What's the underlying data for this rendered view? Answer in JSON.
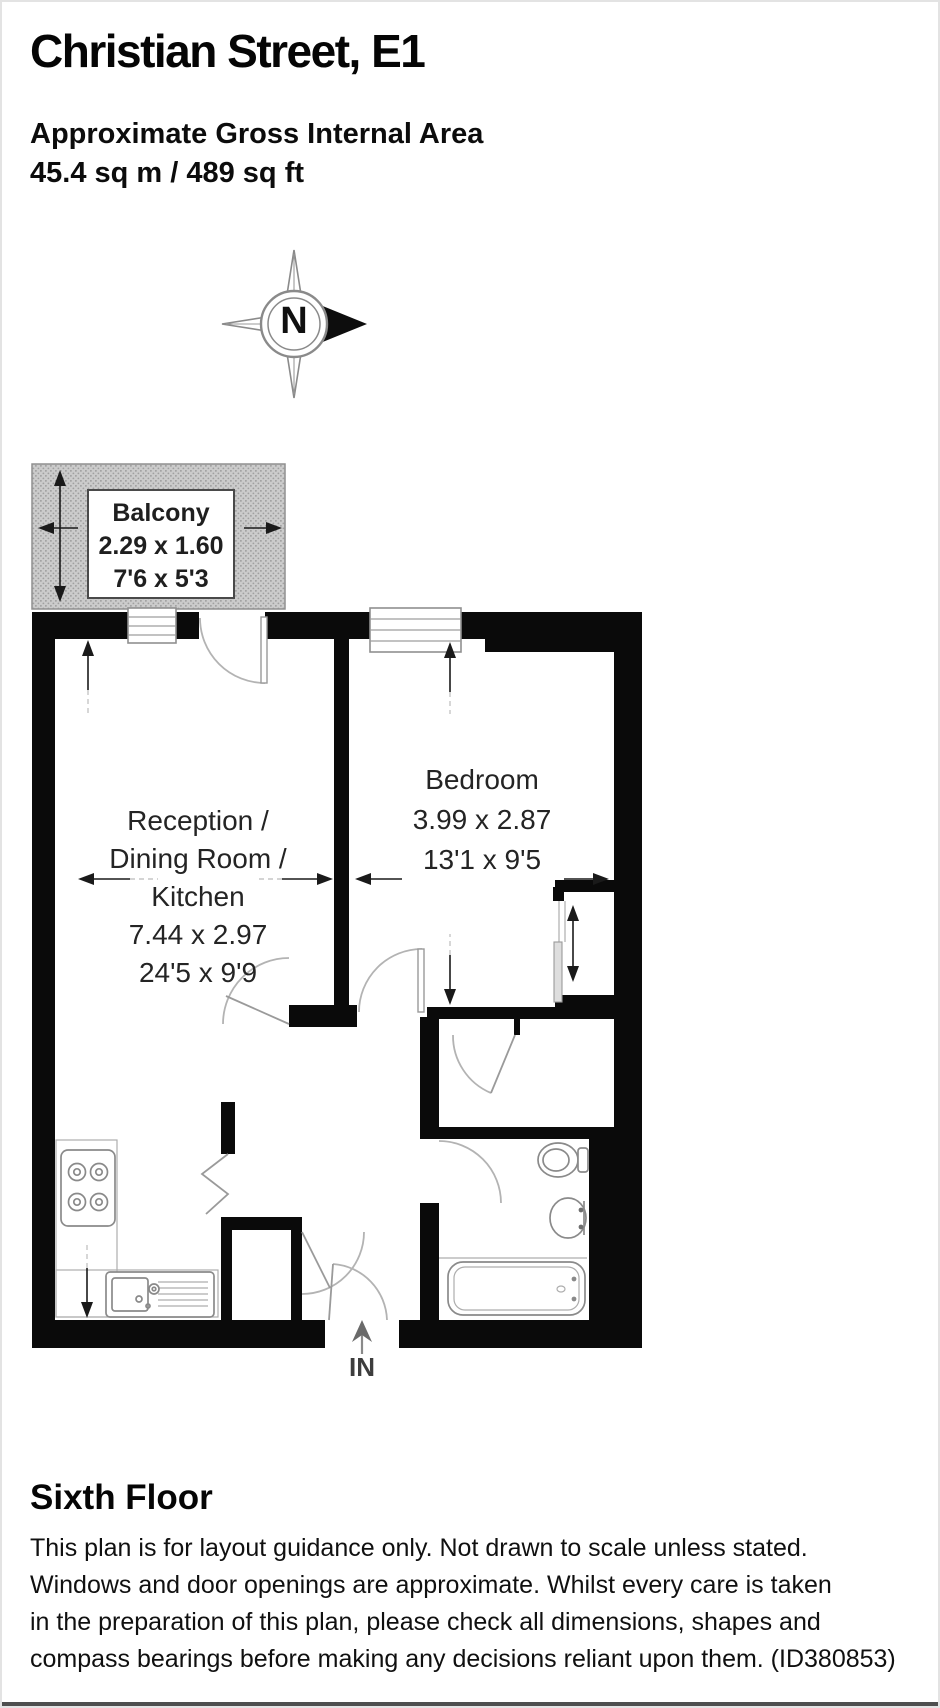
{
  "header": {
    "title": "Christian Street, E1",
    "area_heading": "Approximate Gross Internal Area",
    "area_value": "45.4 sq m / 489 sq ft"
  },
  "compass": {
    "north_label": "N"
  },
  "plan": {
    "balcony": {
      "name": "Balcony",
      "dim_metric": "2.29 x 1.60",
      "dim_imperial": "7'6 x 5'3"
    },
    "reception": {
      "lines": [
        "Reception /",
        "Dining Room /",
        "Kitchen",
        "7.44 x 2.97",
        "24'5 x 9'9"
      ]
    },
    "bedroom": {
      "lines": [
        "Bedroom",
        "3.99 x 2.87",
        "13'1 x 9'5"
      ]
    },
    "entrance_label": "IN"
  },
  "footer": {
    "floor_label": "Sixth Floor",
    "disclaimer_lines": [
      "This plan is for layout guidance only. Not drawn to scale unless stated.",
      "Windows and door openings are approximate. Whilst every care is taken",
      "in the preparation of this plan, please check all dimensions, shapes and",
      "compass bearings before making any decisions reliant upon them. (ID380853)"
    ]
  },
  "colors": {
    "wall": "#0a0a0a",
    "hatch": "#cbcbcb",
    "fixture": "#8a8a8a",
    "door": "#b3b3b3",
    "arrow": "#1a1a1a",
    "text": "#1c1c1c"
  }
}
